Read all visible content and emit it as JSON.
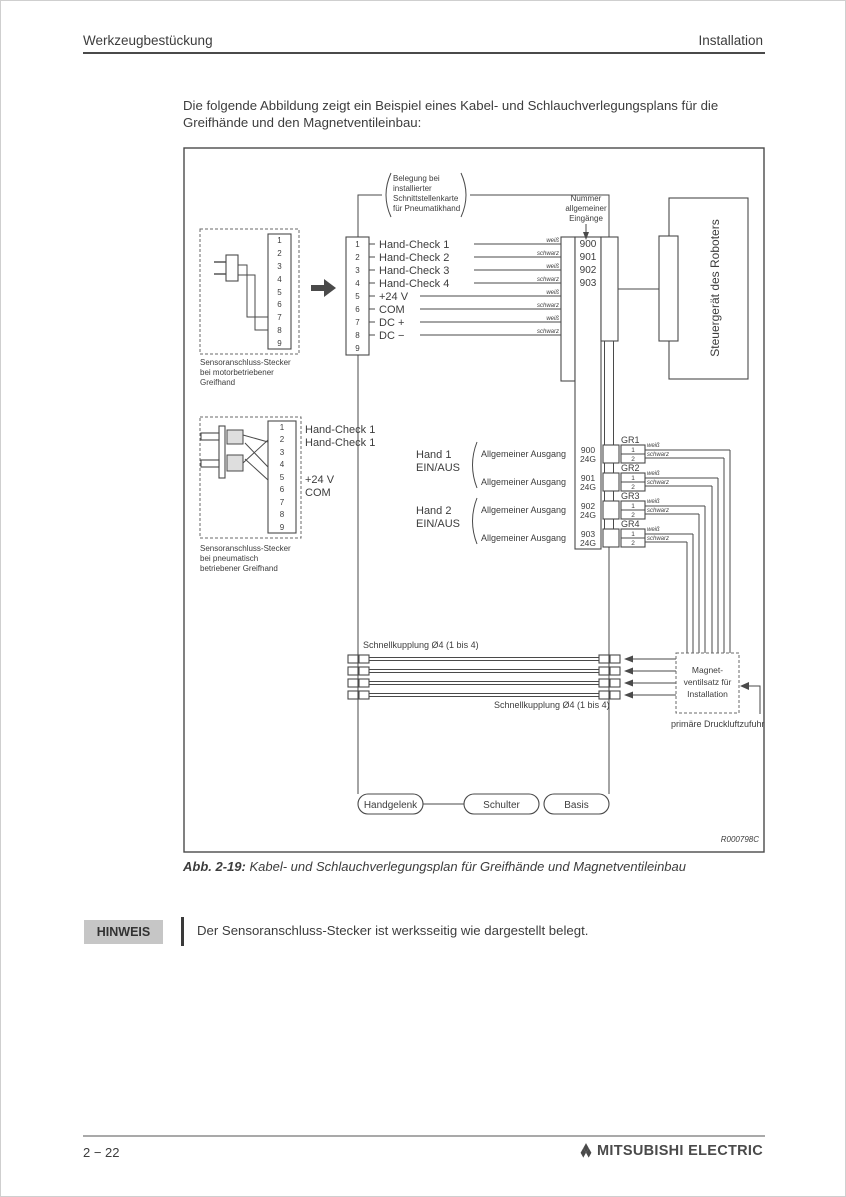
{
  "header": {
    "left": "Werkzeugbestückung",
    "right": "Installation"
  },
  "intro": "Die folgende Abbildung zeigt ein Beispiel eines Kabel- und Schlauchverlegungsplans für die Greifhände und den Magnetventileinbau:",
  "colors": {
    "line": "#4a4a4a",
    "text": "#3d3d3d",
    "note_badge_bg": "#c6c6c6"
  },
  "diagram": {
    "pin_numbers": [
      "1",
      "2",
      "3",
      "4",
      "5",
      "6",
      "7",
      "8",
      "9"
    ],
    "note_top": [
      "Belegung bei",
      "installierter",
      "Schnittstellenkarte",
      "für Pneumatikhand"
    ],
    "input_header": [
      "Nummer",
      "allgemeiner",
      "Eingänge"
    ],
    "connector1": {
      "caption": [
        "Sensoranschluss-Stecker",
        "bei motorbetriebener",
        "Greifhand"
      ]
    },
    "main_block": {
      "labels": [
        "Hand-Check 1",
        "Hand-Check 2",
        "Hand-Check 3",
        "Hand-Check 4",
        "+24 V",
        "COM",
        "DC +",
        "DC −"
      ],
      "wire_colors": [
        "weiß",
        "schwarz",
        "weiß",
        "schwarz",
        "weiß",
        "schwarz",
        "weiß",
        "schwarz"
      ]
    },
    "input_numbers": [
      "900",
      "901",
      "902",
      "903"
    ],
    "controller": "Steuergerät des Roboters",
    "connector2": {
      "labels": [
        "Hand-Check 1",
        "Hand-Check 1",
        "+24 V",
        "COM"
      ],
      "caption": [
        "Sensoranschluss-Stecker",
        "bei pneumatisch",
        "betriebener Greifhand"
      ]
    },
    "hands": [
      {
        "name": "Hand 1",
        "state": "EIN/AUS"
      },
      {
        "name": "Hand 2",
        "state": "EIN/AUS"
      }
    ],
    "outputs": [
      {
        "label": "Allgemeiner Ausgang",
        "num": "900",
        "gnd": "24G",
        "gr": "GR1",
        "pin1": "1",
        "pin2": "2",
        "c1": "weiß",
        "c2": "schwarz"
      },
      {
        "label": "Allgemeiner Ausgang",
        "num": "901",
        "gnd": "24G",
        "gr": "GR2",
        "pin1": "1",
        "pin2": "2",
        "c1": "weiß",
        "c2": "schwarz"
      },
      {
        "label": "Allgemeiner Ausgang",
        "num": "902",
        "gnd": "24G",
        "gr": "GR3",
        "pin1": "1",
        "pin2": "2",
        "c1": "weiß",
        "c2": "schwarz"
      },
      {
        "label": "Allgemeiner Ausgang",
        "num": "903",
        "gnd": "24G",
        "gr": "GR4",
        "pin1": "1",
        "pin2": "2",
        "c1": "weiß",
        "c2": "schwarz"
      }
    ],
    "quick_coupling_top": "Schnellkupplung Ø4 (1 bis 4)",
    "quick_coupling_bottom": "Schnellkupplung Ø4 (1 bis 4)",
    "valve_box": [
      "Magnet-",
      "ventilsatz für",
      "Installation"
    ],
    "air_supply": "primäre Druckluftzufuhr",
    "arm": [
      "Handgelenk",
      "Schulter",
      "Basis"
    ],
    "ref": "R000798C"
  },
  "caption": {
    "label": "Abb. 2-19:",
    "text": "Kabel- und Schlauchverlegungsplan für Greifhände und Magnetventileinbau"
  },
  "note": {
    "label": "HINWEIS",
    "text": "Der Sensoranschluss-Stecker ist werksseitig wie dargestellt belegt."
  },
  "footer": {
    "page": "2 − 22",
    "brand": "MITSUBISHI ELECTRIC"
  }
}
